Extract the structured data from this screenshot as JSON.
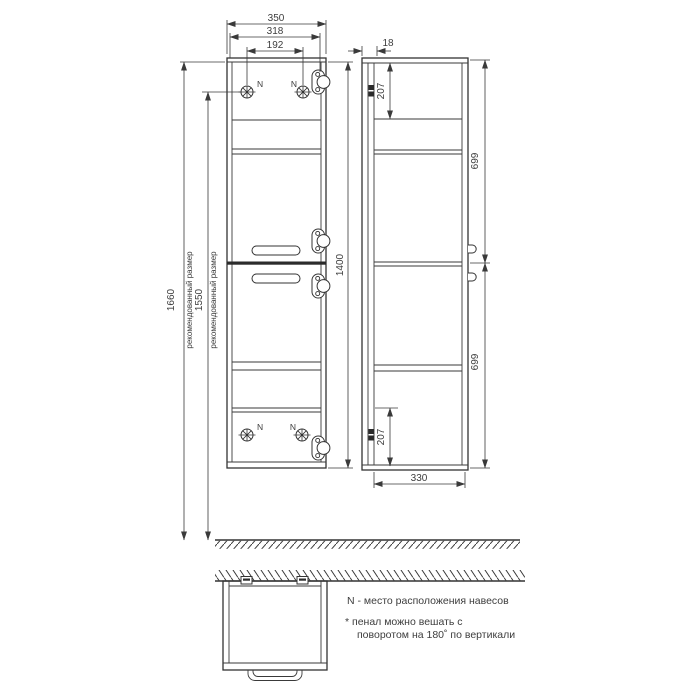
{
  "front_view": {
    "dim_width": "350",
    "dim_width_to_hinge": "318",
    "dim_hanger_spacing": "192",
    "dim_height": "1400",
    "hanger_mark": "N"
  },
  "height_dims": {
    "overall": {
      "value": "1660",
      "note": "рекомендованный размер"
    },
    "to_hangers": {
      "value": "1550",
      "note": "рекомендованный размер"
    }
  },
  "side_view": {
    "dim_back_panel": "18",
    "dim_top_hanger_offset": "207",
    "dim_upper_section": "699",
    "dim_lower_section": "699",
    "dim_bottom_hanger_offset": "207",
    "dim_depth": "330"
  },
  "notes": {
    "hanger_legend": "N - место расположения навесов",
    "mounting_line1": "* пенал можно вешать с",
    "mounting_line2": "поворотом на 180˚ по вертикали"
  }
}
